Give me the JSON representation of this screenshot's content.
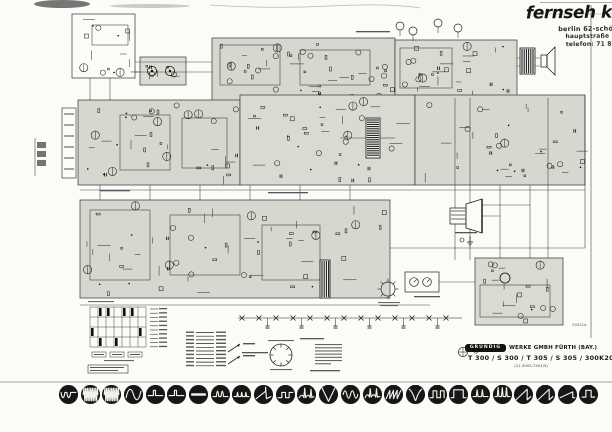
{
  "stamp": {
    "title": "fernseh kr",
    "lines": [
      "berlin 62-schö.",
      "hauptstraße 1",
      "telefon: 71 80"
    ]
  },
  "title_block": {
    "brand": "GRUNDIG",
    "maker": "WERKE GMBH FÜRTH (BAY.)",
    "models": "T 300 / S 300 / T 305 / S 305 / 300K20",
    "part_no": "(21-3003-7501/5)"
  },
  "drawing_number": "29021a",
  "scope_row": {
    "items": [
      {
        "label": "1",
        "wave": "uu"
      },
      {
        "label": "2",
        "wave": "burst"
      },
      {
        "label": "3",
        "wave": "burst"
      },
      {
        "label": "4",
        "wave": "sine1"
      },
      {
        "label": "5",
        "wave": "pulse"
      },
      {
        "label": "5a",
        "wave": "pulse"
      },
      {
        "label": "6",
        "wave": "bar"
      },
      {
        "label": "6a",
        "wave": "twin"
      },
      {
        "label": "7",
        "wave": "smallpulses"
      },
      {
        "label": "8",
        "wave": "rampspike"
      },
      {
        "label": "9",
        "wave": "steps"
      },
      {
        "label": "10",
        "wave": "curvespikes"
      },
      {
        "label": "11",
        "wave": "deepV"
      },
      {
        "label": "12",
        "wave": "sinemulti"
      },
      {
        "label": "13",
        "wave": "pulsecurve"
      },
      {
        "label": "14",
        "wave": "sawtooth"
      },
      {
        "label": "15",
        "wave": "vloops"
      },
      {
        "label": "16",
        "wave": "square"
      },
      {
        "label": "17",
        "wave": "widepulse"
      },
      {
        "label": "18",
        "wave": "pulsetrain"
      },
      {
        "label": "19",
        "wave": "spikes"
      },
      {
        "label": "20",
        "wave": "ramp"
      },
      {
        "label": "21",
        "wave": "ramp"
      },
      {
        "label": "22",
        "wave": "rampshallow"
      },
      {
        "label": "23",
        "wave": "squarepulse"
      }
    ]
  }
}
